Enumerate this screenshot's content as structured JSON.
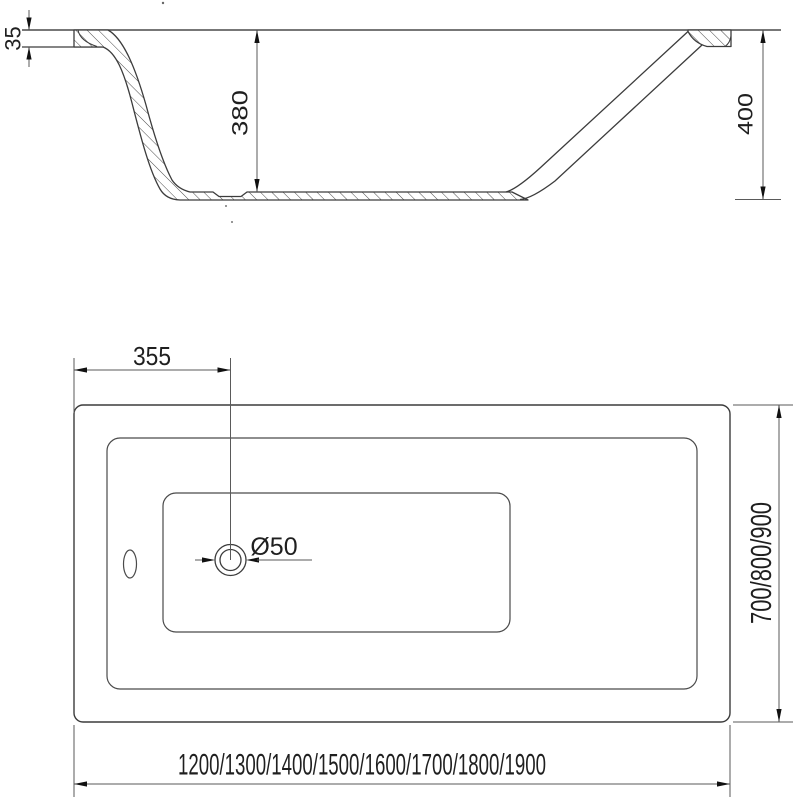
{
  "drawing": {
    "kind": "bathtub technical drawing",
    "section": {
      "rim_thickness": "35",
      "inner_depth": "380",
      "overall_height": "400"
    },
    "plan": {
      "drain_offset": "355",
      "drain_diameter": "Ø50",
      "width_options": "700/800/900",
      "length_options": "1200/1300/1400/1500/1600/1700/1800/1900"
    },
    "colors": {
      "object_line": "#3c3c3c",
      "dimension_line": "#5a5a5a",
      "arrow": "#111111",
      "background": "#ffffff"
    }
  }
}
